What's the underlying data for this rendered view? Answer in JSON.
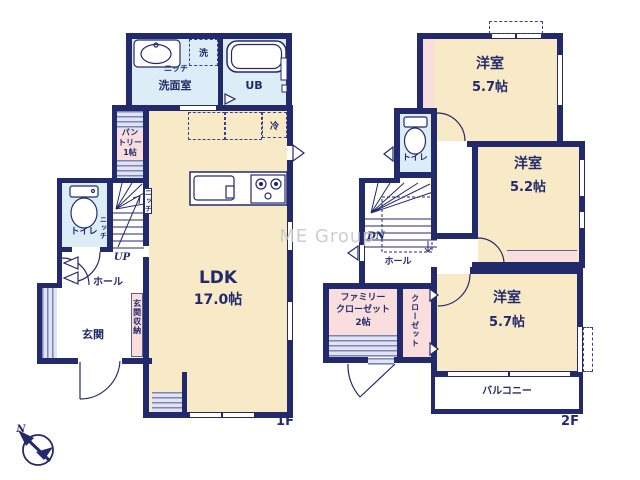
{
  "watermark": "ME Group",
  "compass": {
    "north": "N"
  },
  "palette": {
    "wall": "#232a6c",
    "room_cream": "#f8e9c7",
    "wet_blue": "#ddedf8",
    "closet_pink": "#fadede",
    "watermark_gray": "#c8c8c8"
  },
  "floor1": {
    "floor_label": "1F",
    "washroom": {
      "name": "洗面室",
      "niche": "ニッチ",
      "washer": "洗"
    },
    "unit_bath": {
      "name": "UB"
    },
    "pantry": {
      "line1": "パン",
      "line2": "トリー",
      "size": "1帖"
    },
    "fridge": "冷",
    "ldk": {
      "name": "LDK",
      "size": "17.0帖",
      "stair_niche": "ニッチ"
    },
    "stairs": {
      "label": "UP"
    },
    "toilet": {
      "name": "トイレ",
      "niche": "ニッチ"
    },
    "hall": {
      "name": "ホール"
    },
    "entrance_storage": "玄関収納",
    "entrance": "玄関"
  },
  "floor2": {
    "floor_label": "2F",
    "bedroom_north": {
      "name": "洋室",
      "size": "5.7帖"
    },
    "toilet": {
      "name": "トイレ"
    },
    "bedroom_east": {
      "name": "洋室",
      "size": "5.2帖"
    },
    "stairs": {
      "label": "DN"
    },
    "hall": {
      "name": "ホール"
    },
    "family_closet": {
      "line1": "ファミリー",
      "line2": "クローゼット",
      "size": "2帖"
    },
    "closet": "クローゼット",
    "bedroom_south": {
      "name": "洋室",
      "size": "5.7帖"
    },
    "balcony": "バルコニー"
  }
}
